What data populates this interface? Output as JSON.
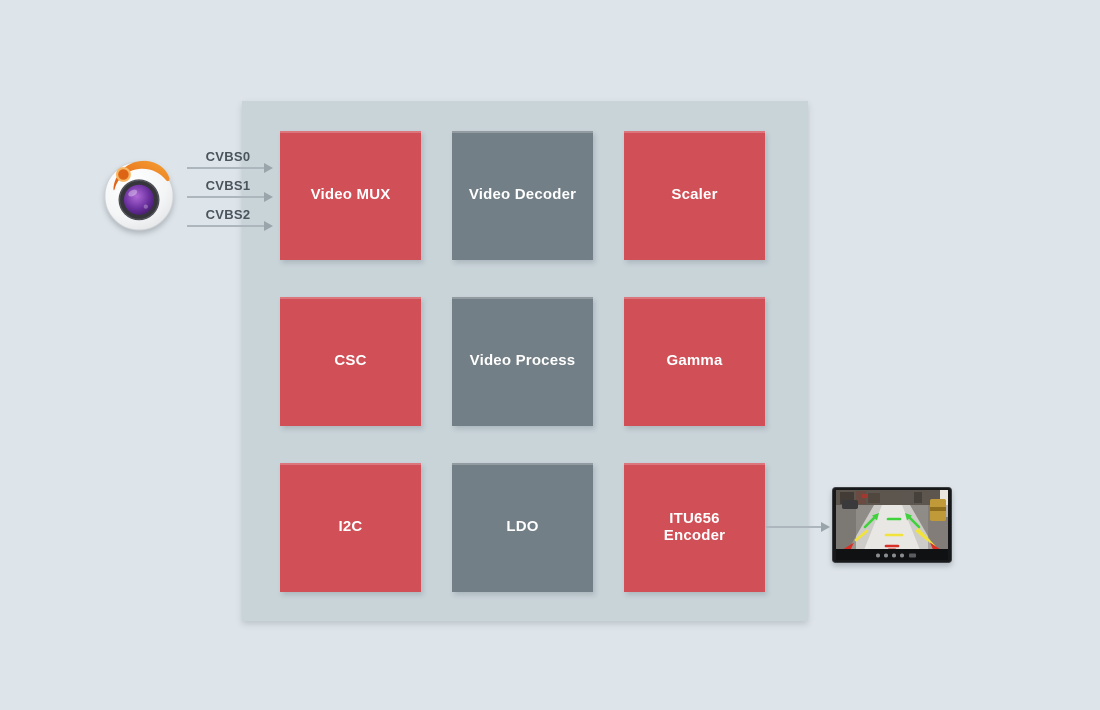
{
  "diagram": {
    "inputs": [
      {
        "label": "CVBS0"
      },
      {
        "label": "CVBS1"
      },
      {
        "label": "CVBS2"
      }
    ],
    "blocks": [
      {
        "label": "Video MUX",
        "variant": "red"
      },
      {
        "label": "Video Decoder",
        "variant": "gray"
      },
      {
        "label": "Scaler",
        "variant": "red"
      },
      {
        "label": "CSC",
        "variant": "red"
      },
      {
        "label": "Video Process",
        "variant": "gray"
      },
      {
        "label": "Gamma",
        "variant": "red"
      },
      {
        "label": "I2C",
        "variant": "red"
      },
      {
        "label": "LDO",
        "variant": "gray"
      },
      {
        "label": "ITU656 Encoder",
        "variant": "red"
      }
    ],
    "icons": {
      "source": "camera-lens-icon",
      "output": "rearview-monitor-icon"
    },
    "colors": {
      "background": "#dee5ea",
      "panel": "#c9d4d9",
      "block_red": "#d15058",
      "block_gray": "#737f86",
      "block_text": "#ffffff",
      "input_label_text": "#4a545c",
      "arrow": "#adb6bc",
      "guide_green": "#3fd23c",
      "guide_yellow": "#f2e23c",
      "guide_red": "#d92f26"
    }
  }
}
